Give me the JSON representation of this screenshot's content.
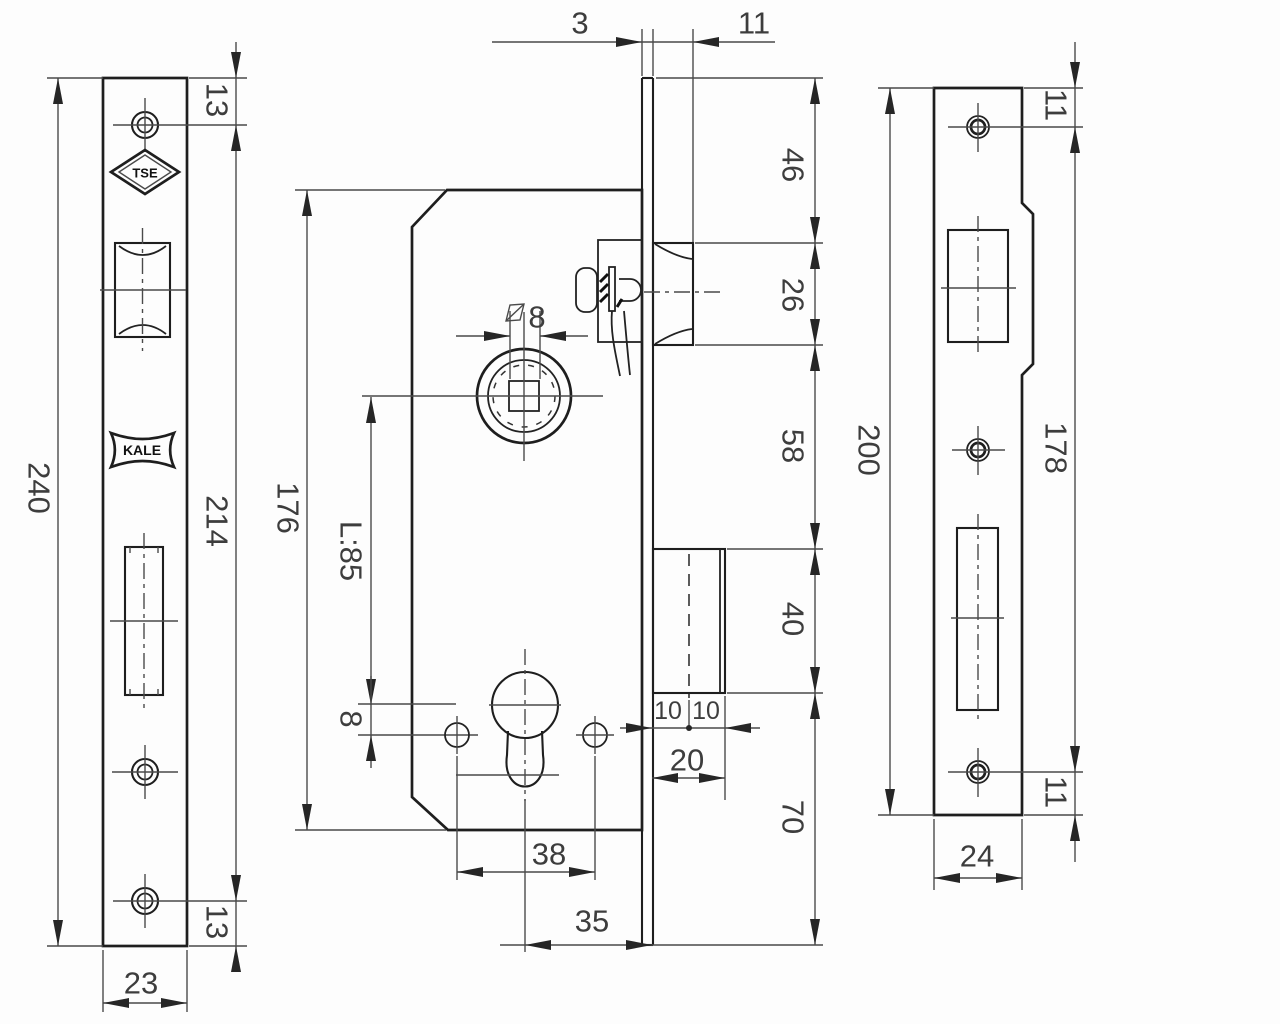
{
  "drawing": {
    "faceplate_view": {
      "dim_total_height": "240",
      "dim_screw_span": "214",
      "dim_top_offset": "13",
      "dim_bottom_offset": "13",
      "dim_width": "23",
      "logo_tse": "TSE",
      "logo_kale": "KALE"
    },
    "body_view": {
      "dim_body_height": "176",
      "dim_spindle_to_cylinder": "L:85",
      "dim_cylinder_to_screws": "8",
      "dim_square_spindle": "8",
      "dim_faceplate_thickness": "3",
      "dim_latch_projection": "11",
      "dim_top_to_latch": "46",
      "dim_latch_height": "26",
      "dim_latch_to_bolt": "58",
      "dim_bolt_height": "40",
      "dim_bolt_to_bottom": "70",
      "dim_bolt_left_half": "10",
      "dim_bolt_right_half": "10",
      "dim_bolt_depth": "20",
      "dim_screw_span": "38",
      "dim_backset": "35"
    },
    "strike_view": {
      "dim_total_height": "200",
      "dim_screw_span": "178",
      "dim_top_offset": "11",
      "dim_bottom_offset": "11",
      "dim_width": "24"
    },
    "colors": {
      "line": "#1e1e1e",
      "dim_line": "#4a4a4a",
      "text": "#3d3d3d",
      "background": "#fdfdfd"
    }
  }
}
